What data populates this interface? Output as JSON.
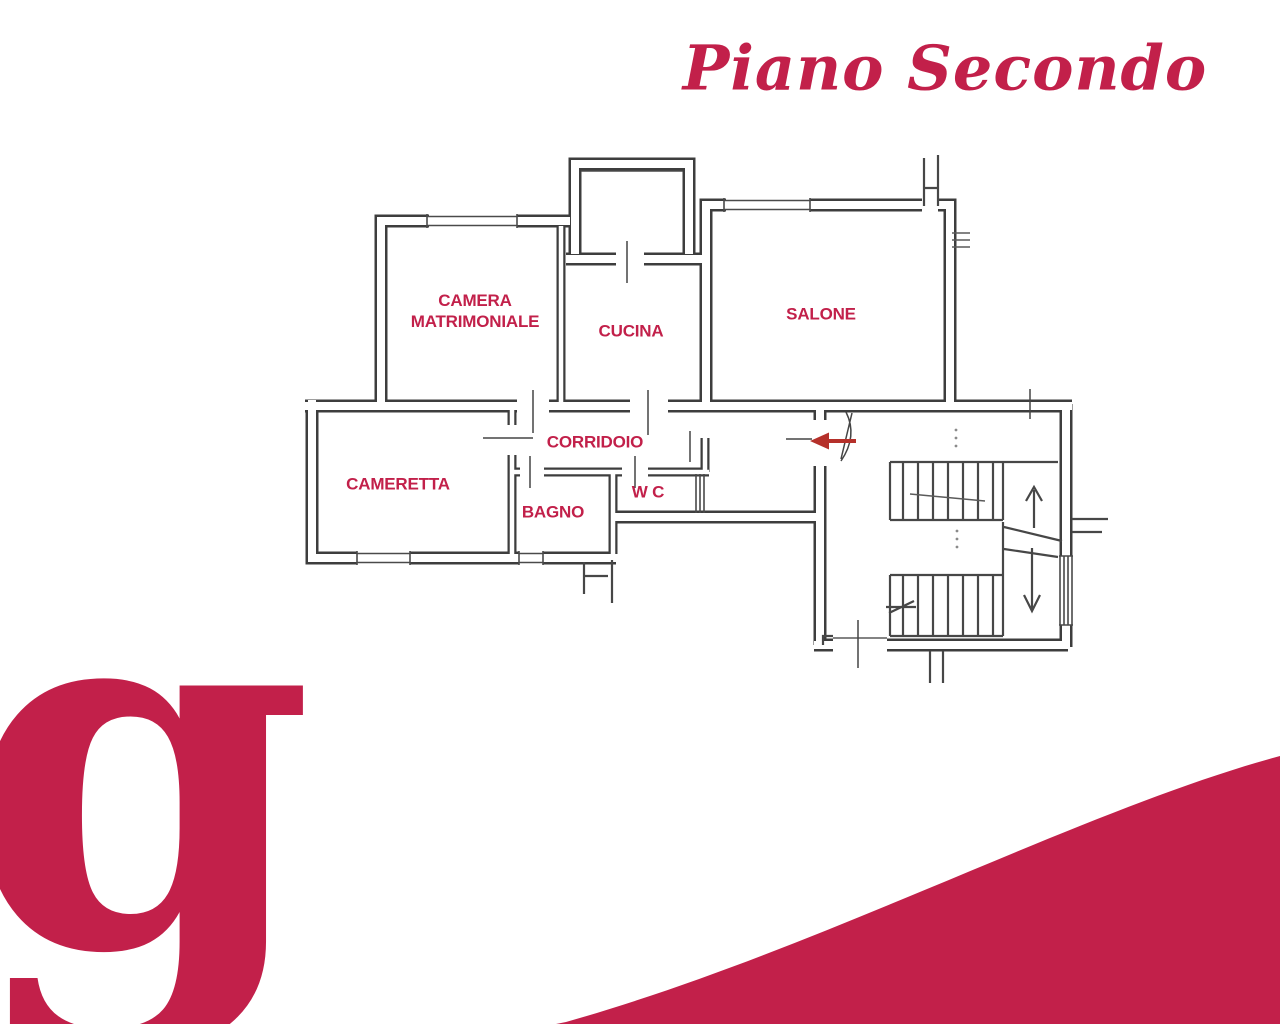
{
  "page": {
    "background_color": "#ffffff",
    "brand_color": "#c2204a",
    "arrow_color": "#b5302a",
    "plan_line_color": "#3d3d3d"
  },
  "title": {
    "text": "Piano Secondo"
  },
  "floor_plan": {
    "rooms": {
      "camera_line1": "CAMERA",
      "camera_line2": "MATRIMONIALE",
      "cucina": "CUCINA",
      "salone": "SALONE",
      "corridoio": "CORRIDOIO",
      "cameretta": "CAMERETTA",
      "wc": "W C",
      "bagno": "BAGNO"
    }
  },
  "logo": {
    "letter": "g"
  }
}
